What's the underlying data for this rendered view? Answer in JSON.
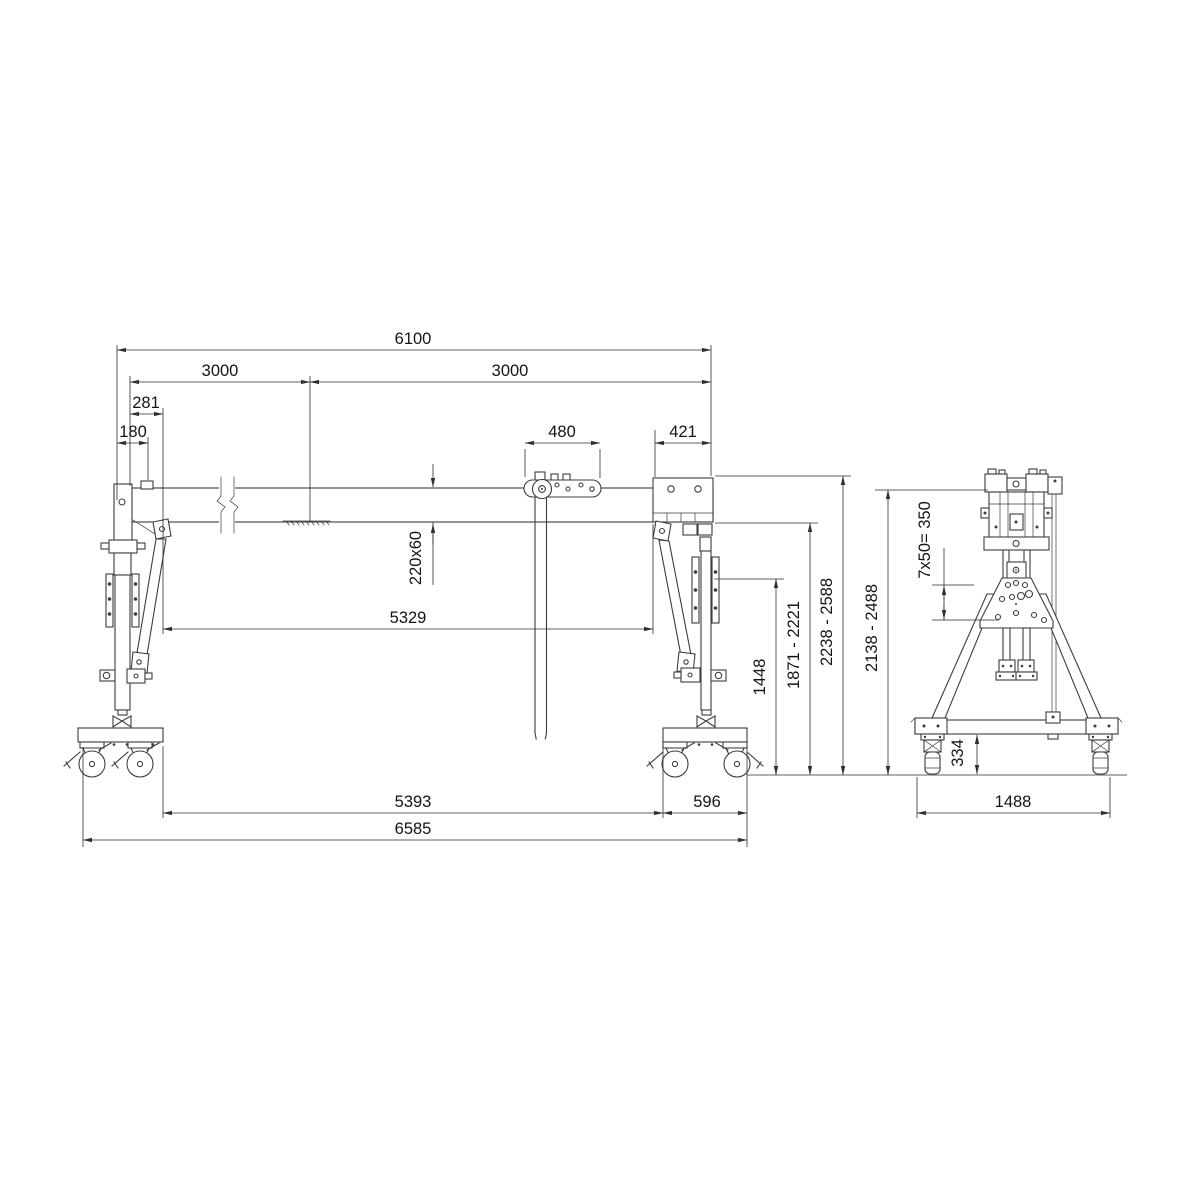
{
  "front_view": {
    "label": "gantry-crane-front-elevation",
    "dims": {
      "rail_total": "6100",
      "rail_half_left": "3000",
      "rail_half_right": "3000",
      "end_offset": "281",
      "buffer_offset": "180",
      "trolley_length": "480",
      "head_length": "421",
      "beam_profile": "220x60",
      "clear_width": "5329",
      "clamp_height": "1448",
      "hook_range": "1871 - 2221",
      "underbeam_range": "2238 - 2588",
      "wheel_span_inner": "5393",
      "bogie_length": "596",
      "overall_length": "6585"
    }
  },
  "side_view": {
    "label": "gantry-crane-side-elevation",
    "dims": {
      "height_range": "2138 - 2488",
      "bolt_pattern": "7x50= 350",
      "caster_height": "334",
      "base_width": "1488"
    }
  }
}
